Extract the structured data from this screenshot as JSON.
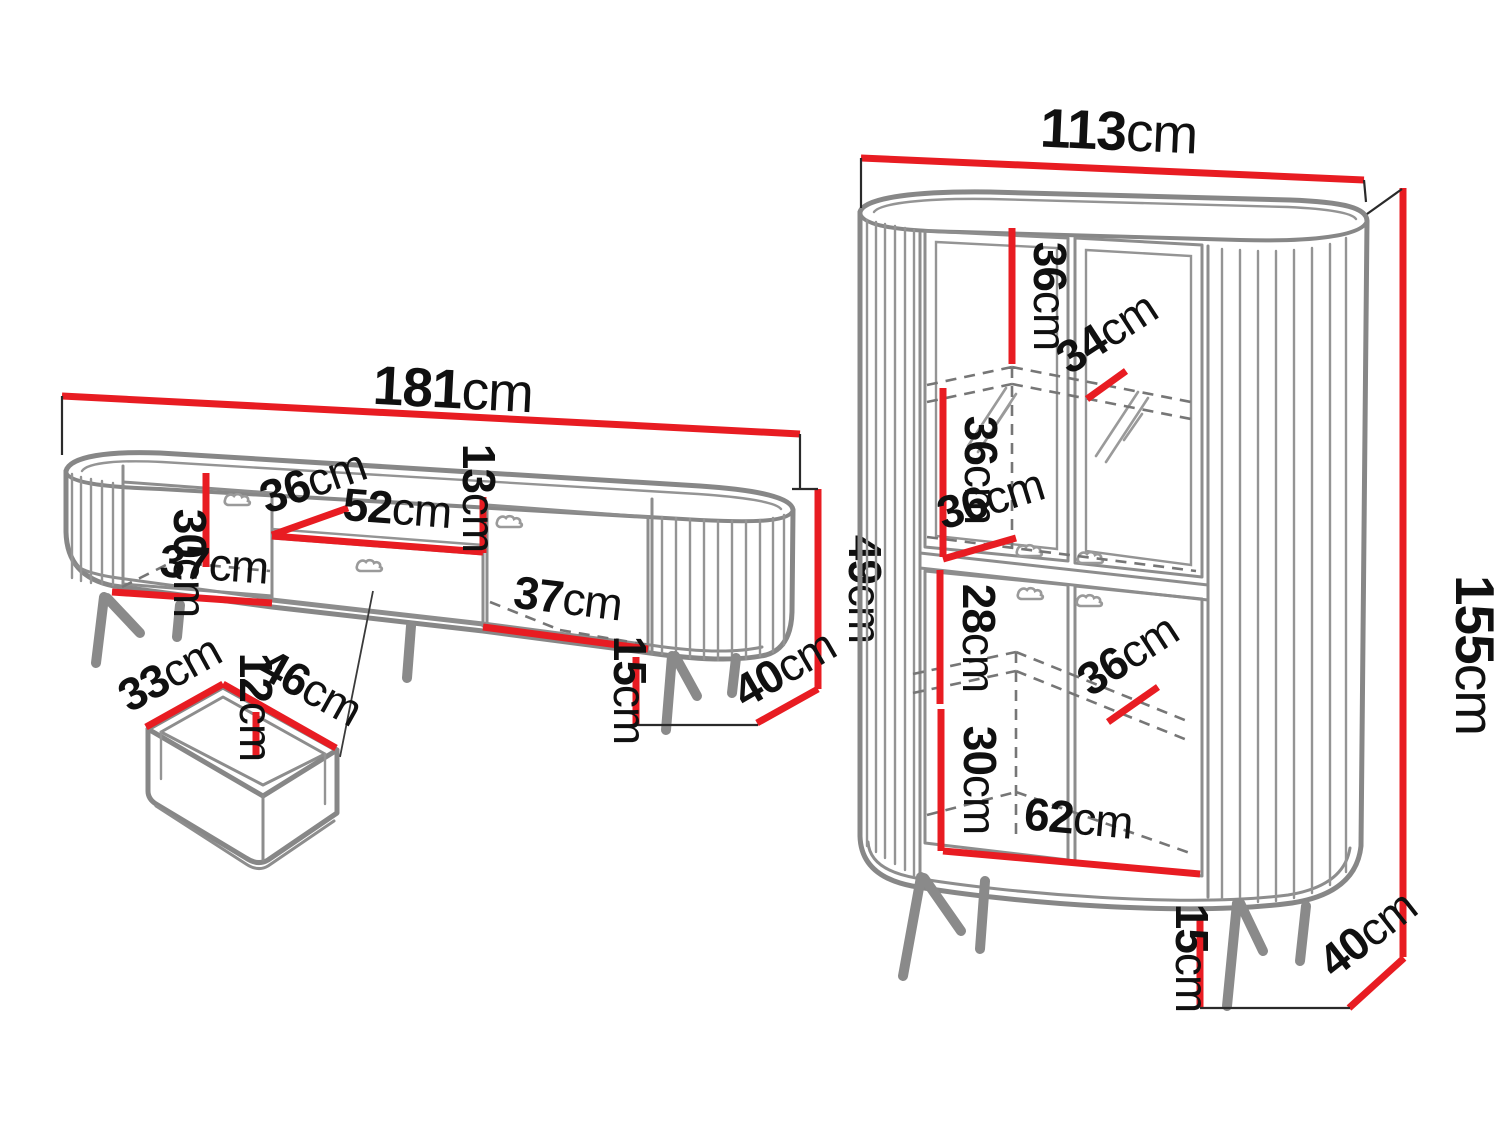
{
  "canvas": {
    "width": 1500,
    "height": 1125,
    "background": "#ffffff"
  },
  "colors": {
    "dimension_red": "#e81c22",
    "outline_gray": "#878787",
    "text": "#101010"
  },
  "tv_stand": {
    "dimensions": {
      "width": {
        "num": "181",
        "unit": "cm"
      },
      "door_height": {
        "num": "30",
        "unit": "cm"
      },
      "niche_depth": {
        "num": "36",
        "unit": "cm"
      },
      "niche_width": {
        "num": "52",
        "unit": "cm"
      },
      "niche_height": {
        "num": "13",
        "unit": "cm"
      },
      "left_inner_width": {
        "num": "37",
        "unit": "cm"
      },
      "right_inner_width": {
        "num": "37",
        "unit": "cm"
      },
      "body_height": {
        "num": "49",
        "unit": "cm"
      },
      "leg_height": {
        "num": "15",
        "unit": "cm"
      },
      "depth": {
        "num": "40",
        "unit": "cm"
      }
    }
  },
  "drawer_detail": {
    "dimensions": {
      "inner_width": {
        "num": "33",
        "unit": "cm"
      },
      "inner_depth": {
        "num": "46",
        "unit": "cm"
      },
      "inner_height": {
        "num": "12",
        "unit": "cm"
      }
    }
  },
  "cabinet": {
    "dimensions": {
      "width": {
        "num": "113",
        "unit": "cm"
      },
      "top_section_height": {
        "num": "36",
        "unit": "cm"
      },
      "top_shelf_depth": {
        "num": "34",
        "unit": "cm"
      },
      "mid_section_height": {
        "num": "36",
        "unit": "cm"
      },
      "mid_shelf_depth": {
        "num": "36",
        "unit": "cm"
      },
      "lower_upper_height": {
        "num": "28",
        "unit": "cm"
      },
      "lower_shelf_depth": {
        "num": "36",
        "unit": "cm"
      },
      "lower_bottom_height": {
        "num": "30",
        "unit": "cm"
      },
      "inner_width": {
        "num": "62",
        "unit": "cm"
      },
      "height": {
        "num": "155",
        "unit": "cm"
      },
      "leg_height": {
        "num": "15",
        "unit": "cm"
      },
      "depth": {
        "num": "40",
        "unit": "cm"
      }
    }
  }
}
